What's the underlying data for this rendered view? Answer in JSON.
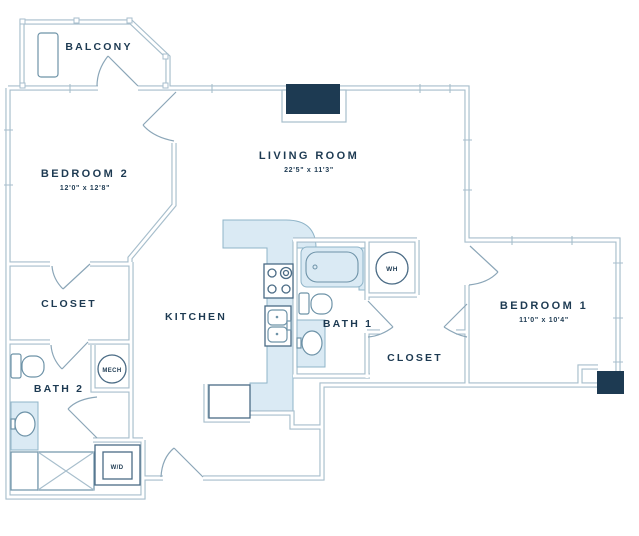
{
  "colors": {
    "ink": "#1d3a52",
    "wall_line": "#a7becc",
    "fixture_line": "#6e93a8",
    "light_fill": "#daeaf4",
    "dark_fill": "#1d3a52",
    "background": "#ffffff"
  },
  "rooms": {
    "balcony": {
      "label": "BALCONY"
    },
    "bedroom2": {
      "label": "BEDROOM 2",
      "dimensions": "12'0\" x 12'8\""
    },
    "living_room": {
      "label": "LIVING ROOM",
      "dimensions": "22'5\" x 11'3\""
    },
    "closet_left": {
      "label": "CLOSET"
    },
    "bath2": {
      "label": "BATH 2"
    },
    "kitchen": {
      "label": "KITCHEN"
    },
    "bath1": {
      "label": "BATH 1"
    },
    "closet_right": {
      "label": "CLOSET"
    },
    "bedroom1": {
      "label": "BEDROOM 1",
      "dimensions": "11'0\" x 10'4\""
    }
  },
  "fixtures": {
    "mech_label": "MECH",
    "water_heater_label": "WH",
    "washer_dryer_label": "W/D"
  }
}
